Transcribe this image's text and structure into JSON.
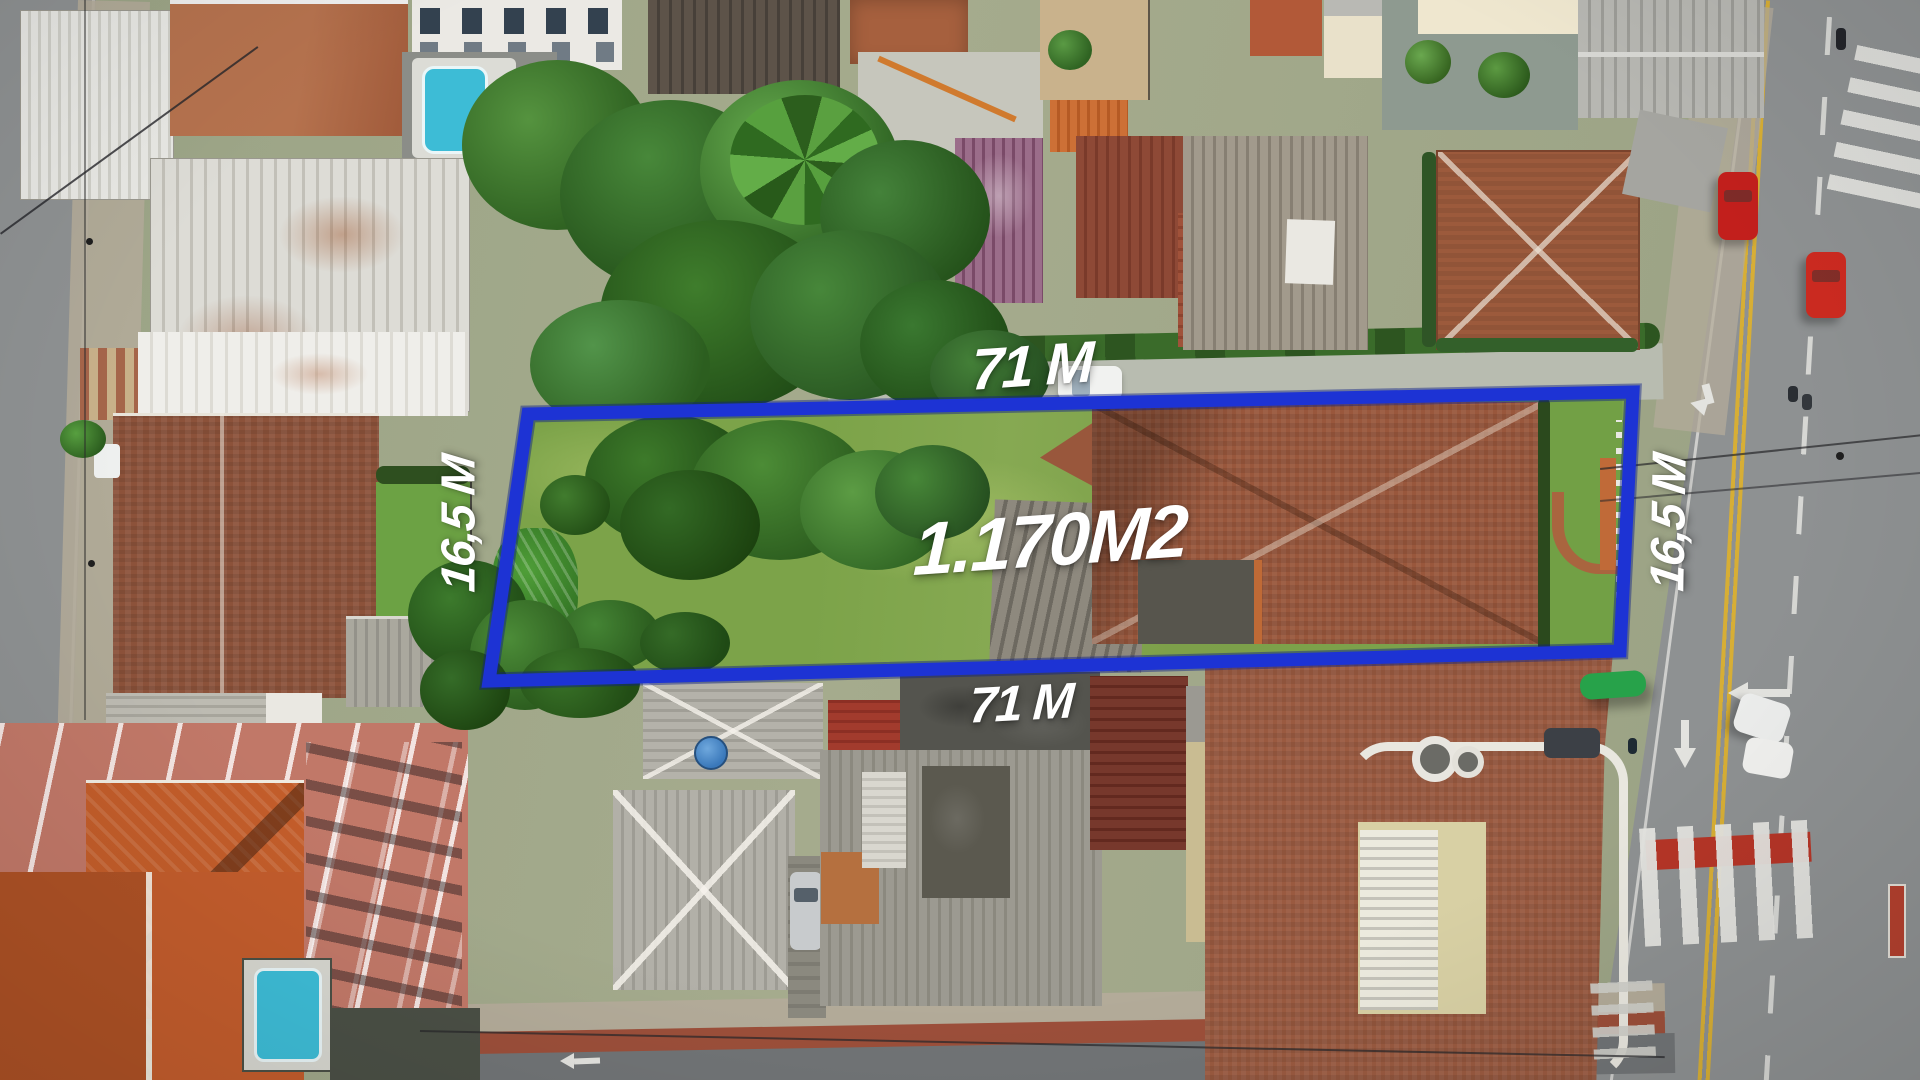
{
  "image": {
    "kind": "aerial-drone-photo",
    "subject": "residential land plot outlined for sale with dimension annotations"
  },
  "annotation": {
    "boundary_color": "#1d33d4",
    "label_color": "#ffffff",
    "labels": {
      "width_top": "71 M",
      "width_bottom": "71 M",
      "depth_left": "16,5 M",
      "depth_right": "16,5 M",
      "area": "1.170M2"
    }
  },
  "palette": {
    "asphalt": "#8e9192",
    "sidewalk": "#b3ab99",
    "lawn": "#7ca349",
    "tree_dark": "#2c5e1f",
    "tree_mid": "#3c772a",
    "tree_light": "#4f9038",
    "roof_terracotta": "#9a5a40",
    "roof_orange": "#c35d2a",
    "roof_gray": "#a9a79d",
    "roof_darkred": "#8e4936",
    "roof_maroon": "#77382c",
    "roof_purple": "#8e5f7a",
    "salmon_building": "#c17868",
    "pool_water": "#3dbcd6",
    "road_yellow_line": "#d7ae35",
    "marking_white": "#e3e3df",
    "crosswalk_red": "#b53527",
    "bus_shelter_green": "#27a24a",
    "water_tank_blue": "#3a78ba"
  }
}
